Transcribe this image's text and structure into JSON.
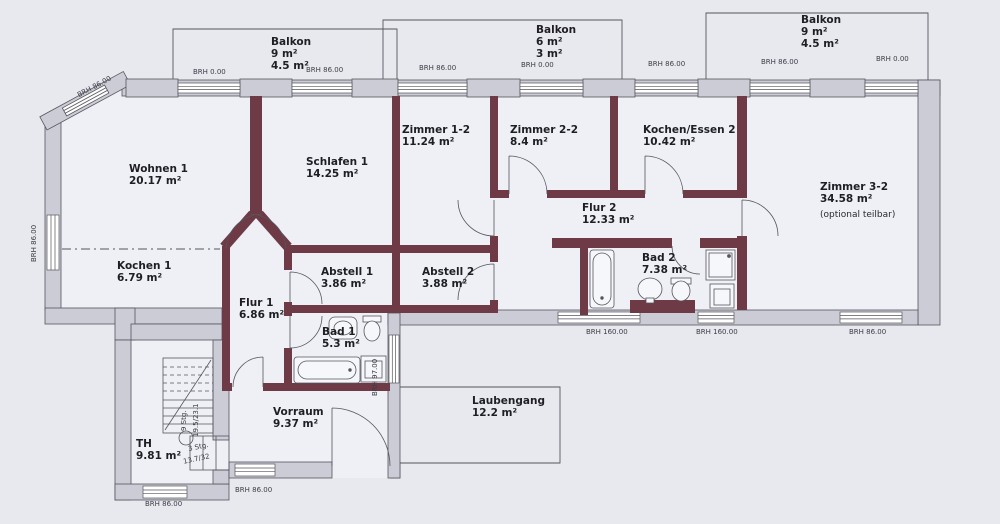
{
  "rooms": {
    "wohnen1": {
      "name": "Wohnen 1",
      "area": "20.17 m²"
    },
    "kochen1": {
      "name": "Kochen 1",
      "area": "6.79 m²"
    },
    "schlafen1": {
      "name": "Schlafen 1",
      "area": "14.25 m²"
    },
    "flur1": {
      "name": "Flur 1",
      "area": "6.86 m²"
    },
    "abstell1": {
      "name": "Abstell 1",
      "area": "3.86 m²"
    },
    "bad1": {
      "name": "Bad 1",
      "area": "5.3 m²"
    },
    "zimmer12": {
      "name": "Zimmer 1-2",
      "area": "11.24 m²"
    },
    "zimmer22": {
      "name": "Zimmer 2-2",
      "area": "8.4 m²"
    },
    "kochenessen2": {
      "name": "Kochen/Essen 2",
      "area": "10.42 m²"
    },
    "flur2": {
      "name": "Flur 2",
      "area": "12.33 m²"
    },
    "abstell2": {
      "name": "Abstell 2",
      "area": "3.88 m²"
    },
    "bad2": {
      "name": "Bad 2",
      "area": "7.38 m²"
    },
    "zimmer32": {
      "name": "Zimmer 3-2",
      "area": "34.58 m²",
      "note": "(optional teilbar)"
    },
    "th": {
      "name": "TH",
      "area": "9.81 m²"
    },
    "vorraum": {
      "name": "Vorraum",
      "area": "9.37 m²"
    },
    "laubengang": {
      "name": "Laubengang",
      "area": "12.2 m²"
    }
  },
  "balconies": {
    "left": {
      "name": "Balkon",
      "area1": "9 m²",
      "area2": "4.5 m²"
    },
    "center": {
      "name": "Balkon",
      "area1": "6 m²",
      "area2": "3 m²"
    },
    "right": {
      "name": "Balkon",
      "area1": "9 m²",
      "area2": "4.5 m²"
    }
  },
  "window_labels": {
    "top_diag": "BRH 86.00",
    "top1": "BRH 0.00",
    "top2": "BRH 86.00",
    "top3": "BRH 86.00",
    "top4": "BRH 0.00",
    "top5": "BRH 86.00",
    "top6": "BRH 86.00",
    "top7": "BRH 0.00",
    "left": "BRH 86.00",
    "south1": "BRH 160.00",
    "south2": "BRH 160.00",
    "south3": "BRH 86.00",
    "bad1_window": "BRH 97.00",
    "vorraum": "BRH 86.00",
    "th": "BRH 86.00"
  },
  "stairs": {
    "count": "9 Stg.",
    "dim": "19.5/23.1",
    "count2": "3 Stg.",
    "dim2": "13.7/32"
  },
  "colors": {
    "background": "#e8e9ef",
    "floor": "#eef0f5",
    "wall_exterior": "#cbccd5",
    "wall_interior": "#6d3a45",
    "line": "#55555e"
  }
}
